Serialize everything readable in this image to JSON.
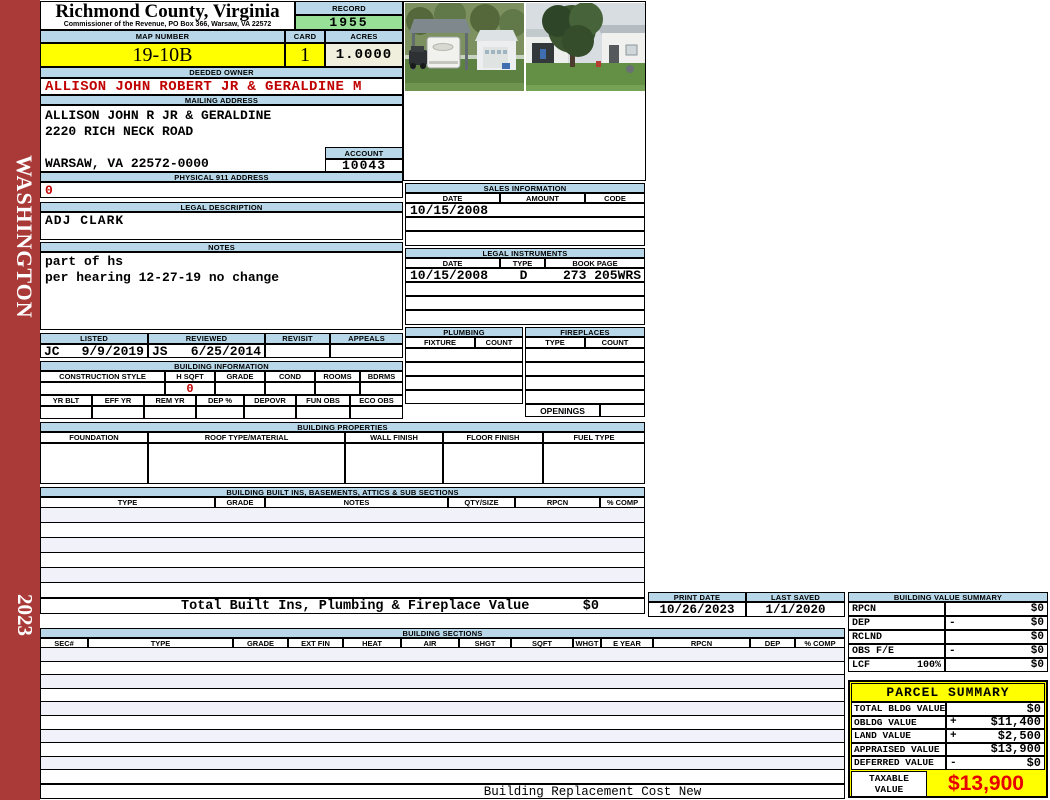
{
  "sidebar": {
    "state": "WASHINGTON",
    "year": "2023"
  },
  "header": {
    "county_title": "Richmond County, Virginia",
    "commissioner_line": "Commissioner of the Revenue, PO Box 366, Warsaw, VA 22572",
    "record": {
      "label": "RECORD",
      "value": "1955"
    },
    "map_number": {
      "label": "MAP NUMBER",
      "value": "19-10B"
    },
    "card": {
      "label": "CARD",
      "value": "1"
    },
    "acres": {
      "label": "ACRES",
      "value": "1.0000"
    }
  },
  "owner": {
    "deeded_owner": {
      "label": "DEEDED OWNER",
      "value": "ALLISON JOHN ROBERT JR & GERALDINE M"
    },
    "mailing_address": {
      "label": "MAILING ADDRESS",
      "line1": "ALLISON JOHN R JR & GERALDINE",
      "line2": "2220 RICH NECK ROAD",
      "line3": "",
      "line4": "WARSAW, VA 22572-0000"
    },
    "account": {
      "label": "ACCOUNT",
      "value": "10043"
    },
    "physical_911": {
      "label": "PHYSICAL 911 ADDRESS",
      "value": "0"
    },
    "legal_description": {
      "label": "LEGAL DESCRIPTION",
      "value": "ADJ CLARK"
    },
    "notes": {
      "label": "NOTES",
      "line1": "part of hs",
      "line2": "per hearing 12-27-19 no change"
    }
  },
  "review": {
    "listed_label": "LISTED",
    "reviewed_label": "REVIEWED",
    "revisit_label": "REVISIT",
    "appeals_label": "APPEALS",
    "listed_by": "JC",
    "listed_date": "9/9/2019",
    "reviewed_by": "JS",
    "reviewed_date": "6/25/2014",
    "revisit_value": "",
    "appeals_value": ""
  },
  "building_information": {
    "title": "BUILDING INFORMATION",
    "row1_headers": [
      "CONSTRUCTION STYLE",
      "H SQFT",
      "GRADE",
      "COND",
      "ROOMS",
      "BDRMS"
    ],
    "hsqft_value": "0",
    "row2_headers": [
      "YR BLT",
      "EFF YR",
      "REM YR",
      "DEP %",
      "DEPOVR",
      "FUN OBS",
      "ECO OBS"
    ]
  },
  "sales_information": {
    "title": "SALES INFORMATION",
    "headers": [
      "DATE",
      "AMOUNT",
      "CODE"
    ],
    "rows": [
      [
        "10/15/2008",
        "",
        ""
      ],
      [
        "",
        "",
        ""
      ],
      [
        "",
        "",
        ""
      ]
    ]
  },
  "legal_instruments": {
    "title": "LEGAL INSTRUMENTS",
    "headers": [
      "DATE",
      "TYPE",
      "BOOK PAGE"
    ],
    "rows": [
      [
        "10/15/2008",
        "D",
        "273 205WRS"
      ],
      [
        "",
        "",
        ""
      ],
      [
        "",
        "",
        ""
      ],
      [
        "",
        "",
        ""
      ]
    ]
  },
  "plumbing": {
    "title": "PLUMBING",
    "headers": [
      "FIXTURE",
      "COUNT"
    ]
  },
  "fireplaces": {
    "title": "FIREPLACES",
    "headers": [
      "TYPE",
      "COUNT"
    ],
    "openings_label": "OPENINGS"
  },
  "building_properties": {
    "title": "BUILDING PROPERTIES",
    "headers": [
      "FOUNDATION",
      "ROOF TYPE/MATERIAL",
      "WALL FINISH",
      "FLOOR FINISH",
      "FUEL TYPE"
    ]
  },
  "built_ins": {
    "title": "BUILDING BUILT INS, BASEMENTS, ATTICS & SUB SECTIONS",
    "headers": [
      "TYPE",
      "GRADE",
      "NOTES",
      "QTY/SIZE",
      "RPCN",
      "% COMP"
    ],
    "total_label": "Total Built Ins, Plumbing & Fireplace Value",
    "total_value": "$0"
  },
  "print_info": {
    "print_date_label": "PRINT DATE",
    "print_date_value": "10/26/2023",
    "last_saved_label": "LAST SAVED",
    "last_saved_value": "1/1/2020"
  },
  "building_value_summary": {
    "title": "BUILDING VALUE SUMMARY",
    "rows": [
      {
        "label": "RPCN",
        "pct": "",
        "op": "",
        "value": "$0"
      },
      {
        "label": "DEP",
        "pct": "",
        "op": "-",
        "value": "$0"
      },
      {
        "label": "RCLND",
        "pct": "",
        "op": "",
        "value": "$0"
      },
      {
        "label": "OBS F/E",
        "pct": "",
        "op": "-",
        "value": "$0"
      },
      {
        "label": "LCF",
        "pct": "100%",
        "op": "",
        "value": "$0"
      }
    ]
  },
  "building_sections": {
    "title": "BUILDING SECTIONS",
    "headers": [
      "SEC#",
      "TYPE",
      "GRADE",
      "EXT FIN",
      "HEAT",
      "AIR",
      "SHGT",
      "SQFT",
      "WHGT",
      "E YEAR",
      "RPCN",
      "DEP",
      "% COMP"
    ],
    "footer_note": "Building Replacement Cost New"
  },
  "parcel_summary": {
    "title": "PARCEL SUMMARY",
    "rows": [
      {
        "label": "TOTAL BLDG VALUE",
        "op": "",
        "value": "$0"
      },
      {
        "label": "OBLDG VALUE",
        "op": "+",
        "value": "$11,400"
      },
      {
        "label": "LAND VALUE",
        "op": "+",
        "value": "$2,500"
      },
      {
        "label": "APPRAISED VALUE",
        "op": "",
        "value": "$13,900"
      },
      {
        "label": "DEFERRED VALUE",
        "op": "-",
        "value": "$0"
      }
    ],
    "taxable_label_line1": "TAXABLE",
    "taxable_label_line2": "VALUE",
    "taxable_value": "$13,900"
  },
  "photos": {
    "left": "carport-with-rv-photo",
    "right": "garage-yard-tree-photo"
  },
  "colors": {
    "band_blue": "#B8D8E9",
    "record_green": "#98DF98",
    "highlight_yellow": "#FFFF00",
    "acres_cream": "#F0EFDE",
    "sidebar_red": "#A93A38",
    "value_red": "#C00000",
    "taxable_red": "#E60000",
    "row_stripe": "#F1F1F9"
  }
}
